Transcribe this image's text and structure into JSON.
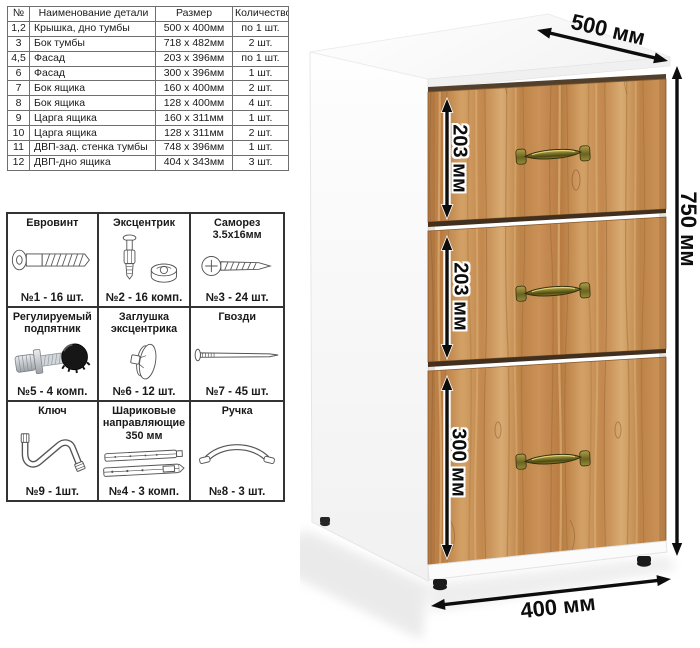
{
  "parts_table": {
    "headers": [
      "№",
      "Наименование детали",
      "Размер",
      "Количество"
    ],
    "rows": [
      {
        "num": "1,2",
        "name": "Крышка, дно тумбы",
        "size": "500 х 400мм",
        "qty": "по 1 шт."
      },
      {
        "num": "3",
        "name": "Бок тумбы",
        "size": "718 х 482мм",
        "qty": "2 шт."
      },
      {
        "num": "4,5",
        "name": "Фасад",
        "size": "203 х 396мм",
        "qty": "по 1 шт."
      },
      {
        "num": "6",
        "name": "Фасад",
        "size": "300 х 396мм",
        "qty": "1 шт."
      },
      {
        "num": "7",
        "name": "Бок ящика",
        "size": "160 х 400мм",
        "qty": "2 шт."
      },
      {
        "num": "8",
        "name": "Бок ящика",
        "size": "128 х 400мм",
        "qty": "4 шт."
      },
      {
        "num": "9",
        "name": "Царга ящика",
        "size": "160 х 311мм",
        "qty": "1 шт."
      },
      {
        "num": "10",
        "name": "Царга ящика",
        "size": "128 х 311мм",
        "qty": "2 шт."
      },
      {
        "num": "11",
        "name": "ДВП-зад. стенка тумбы",
        "size": "748 х 396мм",
        "qty": "1 шт."
      },
      {
        "num": "12",
        "name": "ДВП-дно ящика",
        "size": "404 х 343мм",
        "qty": "3 шт."
      }
    ]
  },
  "hardware": {
    "items": [
      {
        "title": "Евровинт",
        "count": "№1 - 16 шт.",
        "icon": "euroscrew-icon"
      },
      {
        "title": "Эксцентрик",
        "count": "№2 - 16 комп.",
        "icon": "cam-lock-icon"
      },
      {
        "title": "Саморез 3.5х16мм",
        "count": "№3 - 24 шт.",
        "icon": "self-tapping-screw-icon"
      },
      {
        "title": "Регулируемый подпятник",
        "count": "№5 - 4 комп.",
        "icon": "adjustable-foot-icon"
      },
      {
        "title": "Заглушка эксцентрика",
        "count": "№6 - 12 шт.",
        "icon": "cam-cap-icon"
      },
      {
        "title": "Гвозди",
        "count": "№7 - 45 шт.",
        "icon": "nails-icon"
      },
      {
        "title": "Ключ",
        "count": "№9 - 1шт.",
        "icon": "hex-key-icon"
      },
      {
        "title": "Шариковые направляющие 350 мм",
        "count": "№4 - 3 комп.",
        "icon": "ball-slides-icon"
      },
      {
        "title": "Ручка",
        "count": "№8 - 3 шт.",
        "icon": "bow-handle-icon"
      }
    ]
  },
  "cabinet": {
    "dim_top": "500 мм",
    "dim_right": "750 мм",
    "dim_bottom": "400 мм",
    "drawer_dims": [
      "203 мм",
      "203 мм",
      "300 мм"
    ],
    "drawer_count": 3,
    "wood_color": "#c68d54",
    "handle_color": "#77702a",
    "body_color": "#ffffff"
  }
}
